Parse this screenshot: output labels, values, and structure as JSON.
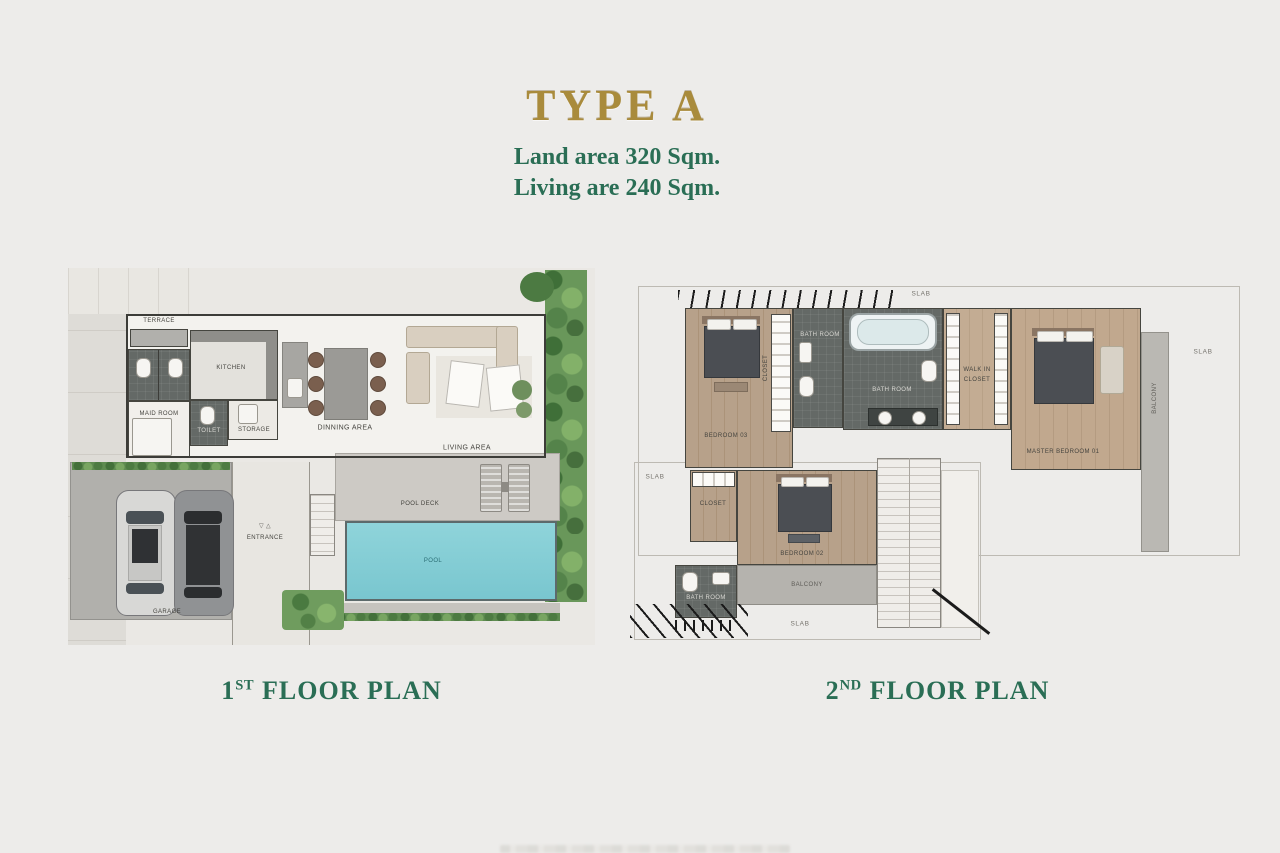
{
  "header": {
    "title": "TYPE A",
    "subtitle_line1": "Land area 320 Sqm.",
    "subtitle_line2": "Living are 240 Sqm."
  },
  "colors": {
    "gold": "#a98b3c",
    "green": "#2a6e55",
    "pool": "#84ced6"
  },
  "floor1": {
    "caption": {
      "num": "1",
      "sup": "ST",
      "rest": "FLOOR PLAN"
    },
    "labels": {
      "terrace": "TERRACE",
      "kitchen": "KITCHEN",
      "maid_room": "MAID ROOM",
      "toilet": "TOILET",
      "storage": "STORAGE",
      "dining": "DINNING AREA",
      "living": "LIVING AREA",
      "pool_deck": "POOL DECK",
      "pool": "POOL",
      "entrance": "ENTRANCE",
      "entrance_arrows": "▽ △",
      "garage": "GARAGE"
    }
  },
  "floor2": {
    "caption": {
      "num": "2",
      "sup": "ND",
      "rest": "FLOOR PLAN"
    },
    "labels": {
      "slab_top": "SLAB",
      "slab_right": "SLAB",
      "slab_left": "SLAB",
      "slab_bottom": "SLAB",
      "bedroom03": "BEDROOM 03",
      "closet03": "CLOSET",
      "bathroom03": "BATH ROOM",
      "master_bath": "BATH ROOM",
      "walkin_line1": "WALK IN",
      "walkin_line2": "CLOSET",
      "master_bedroom": "MASTER BEDROOM 01",
      "balcony_right": "BALCONY",
      "closet02": "CLOSET",
      "bedroom02": "BEDROOM 02",
      "balcony_bottom": "BALCONY",
      "bathroom02": "BATH ROOM"
    }
  }
}
